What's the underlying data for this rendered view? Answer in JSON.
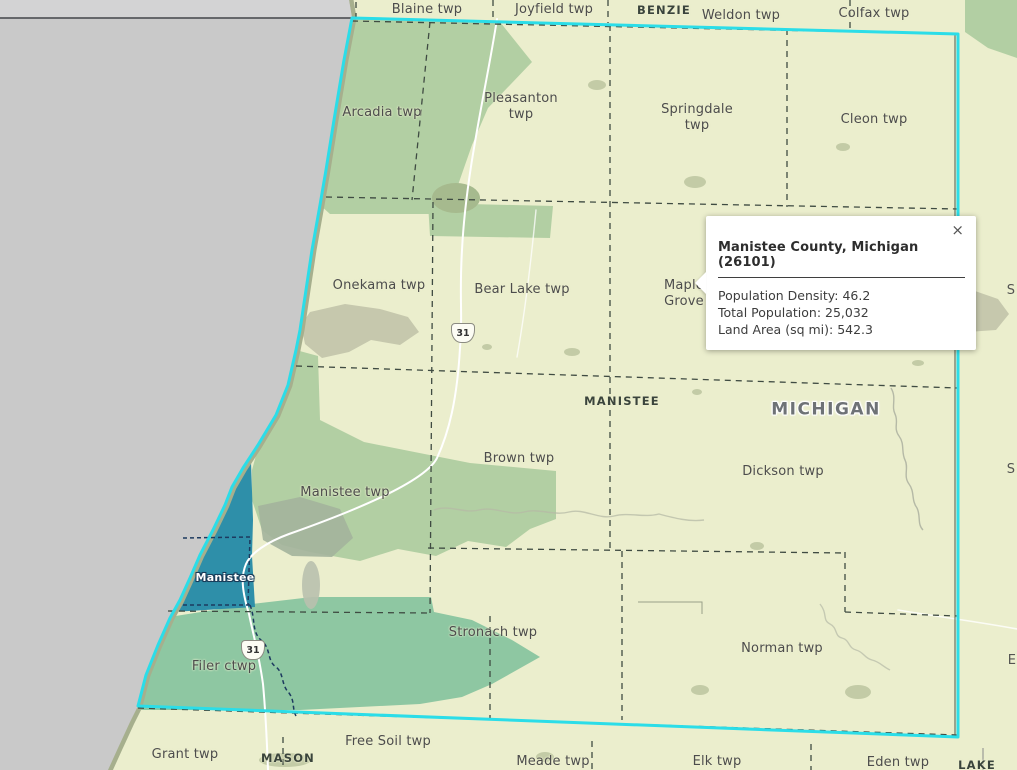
{
  "map": {
    "colors": {
      "land": "#ebeecd",
      "water": "#c9c9c9",
      "county_highlight_boundary": "#2bdde8",
      "public_land_green": "#b2cfa3",
      "public_land_teal": "#8ec7a2",
      "city_fill": "#2e8fa9",
      "shoreline": "#a6af8d",
      "township_boundary": "#3f4b42"
    },
    "labels": {
      "townships": [
        {
          "text": "Blaine twp",
          "x": 427,
          "y": 10
        },
        {
          "text": "Joyfield twp",
          "x": 554,
          "y": 10
        },
        {
          "text": "Weldon twp",
          "x": 741,
          "y": 16
        },
        {
          "text": "Colfax twp",
          "x": 874,
          "y": 14
        },
        {
          "text": "Arcadia twp",
          "x": 382,
          "y": 113
        },
        {
          "text": "Pleasanton\ntwp",
          "x": 521,
          "y": 107
        },
        {
          "text": "Springdale\ntwp",
          "x": 697,
          "y": 118
        },
        {
          "text": "Cleon twp",
          "x": 874,
          "y": 120
        },
        {
          "text": "Onekama twp",
          "x": 379,
          "y": 286
        },
        {
          "text": "Bear Lake twp",
          "x": 522,
          "y": 290
        },
        {
          "text": "Maple\nGrove",
          "x": 684,
          "y": 294
        },
        {
          "text": "Brown twp",
          "x": 519,
          "y": 459
        },
        {
          "text": "Dickson twp",
          "x": 783,
          "y": 472
        },
        {
          "text": "Manistee twp",
          "x": 345,
          "y": 493
        },
        {
          "text": "Stronach twp",
          "x": 493,
          "y": 633
        },
        {
          "text": "Norman twp",
          "x": 782,
          "y": 649
        },
        {
          "text": "Filer ctwp",
          "x": 224,
          "y": 667
        },
        {
          "text": "Grant twp",
          "x": 185,
          "y": 755
        },
        {
          "text": "Free Soil twp",
          "x": 388,
          "y": 742
        },
        {
          "text": "Meade twp",
          "x": 553,
          "y": 762
        },
        {
          "text": "Elk twp",
          "x": 717,
          "y": 762
        },
        {
          "text": "Eden twp",
          "x": 898,
          "y": 763
        }
      ],
      "counties": [
        {
          "text": "BENZIE",
          "x": 664,
          "y": 10
        },
        {
          "text": "MANISTEE",
          "x": 622,
          "y": 401
        },
        {
          "text": "MASON",
          "x": 288,
          "y": 758
        },
        {
          "text": "LAKE",
          "x": 977,
          "y": 765
        }
      ],
      "states": [
        {
          "text": "MICHIGAN",
          "x": 826,
          "y": 410
        }
      ],
      "cities": [
        {
          "text": "Manistee",
          "x": 225,
          "y": 578
        }
      ],
      "cutoff": [
        {
          "text": "S",
          "x": 1011,
          "y": 291
        },
        {
          "text": "S",
          "x": 1011,
          "y": 470
        },
        {
          "text": "E",
          "x": 1012,
          "y": 661
        }
      ]
    },
    "highway_shields": [
      {
        "label": "31",
        "x": 463,
        "y": 333
      },
      {
        "label": "31",
        "x": 253,
        "y": 650
      }
    ]
  },
  "popup": {
    "title": "Manistee County, Michigan (26101)",
    "close_label": "×",
    "stats": [
      {
        "label": "Population Density",
        "value": "46.2",
        "text": "Population Density: 46.2"
      },
      {
        "label": "Total Population",
        "value": "25,032",
        "text": "Total Population: 25,032"
      },
      {
        "label": "Land Area (sq mi)",
        "value": "542.3",
        "text": "Land Area (sq mi): 542.3"
      }
    ]
  }
}
